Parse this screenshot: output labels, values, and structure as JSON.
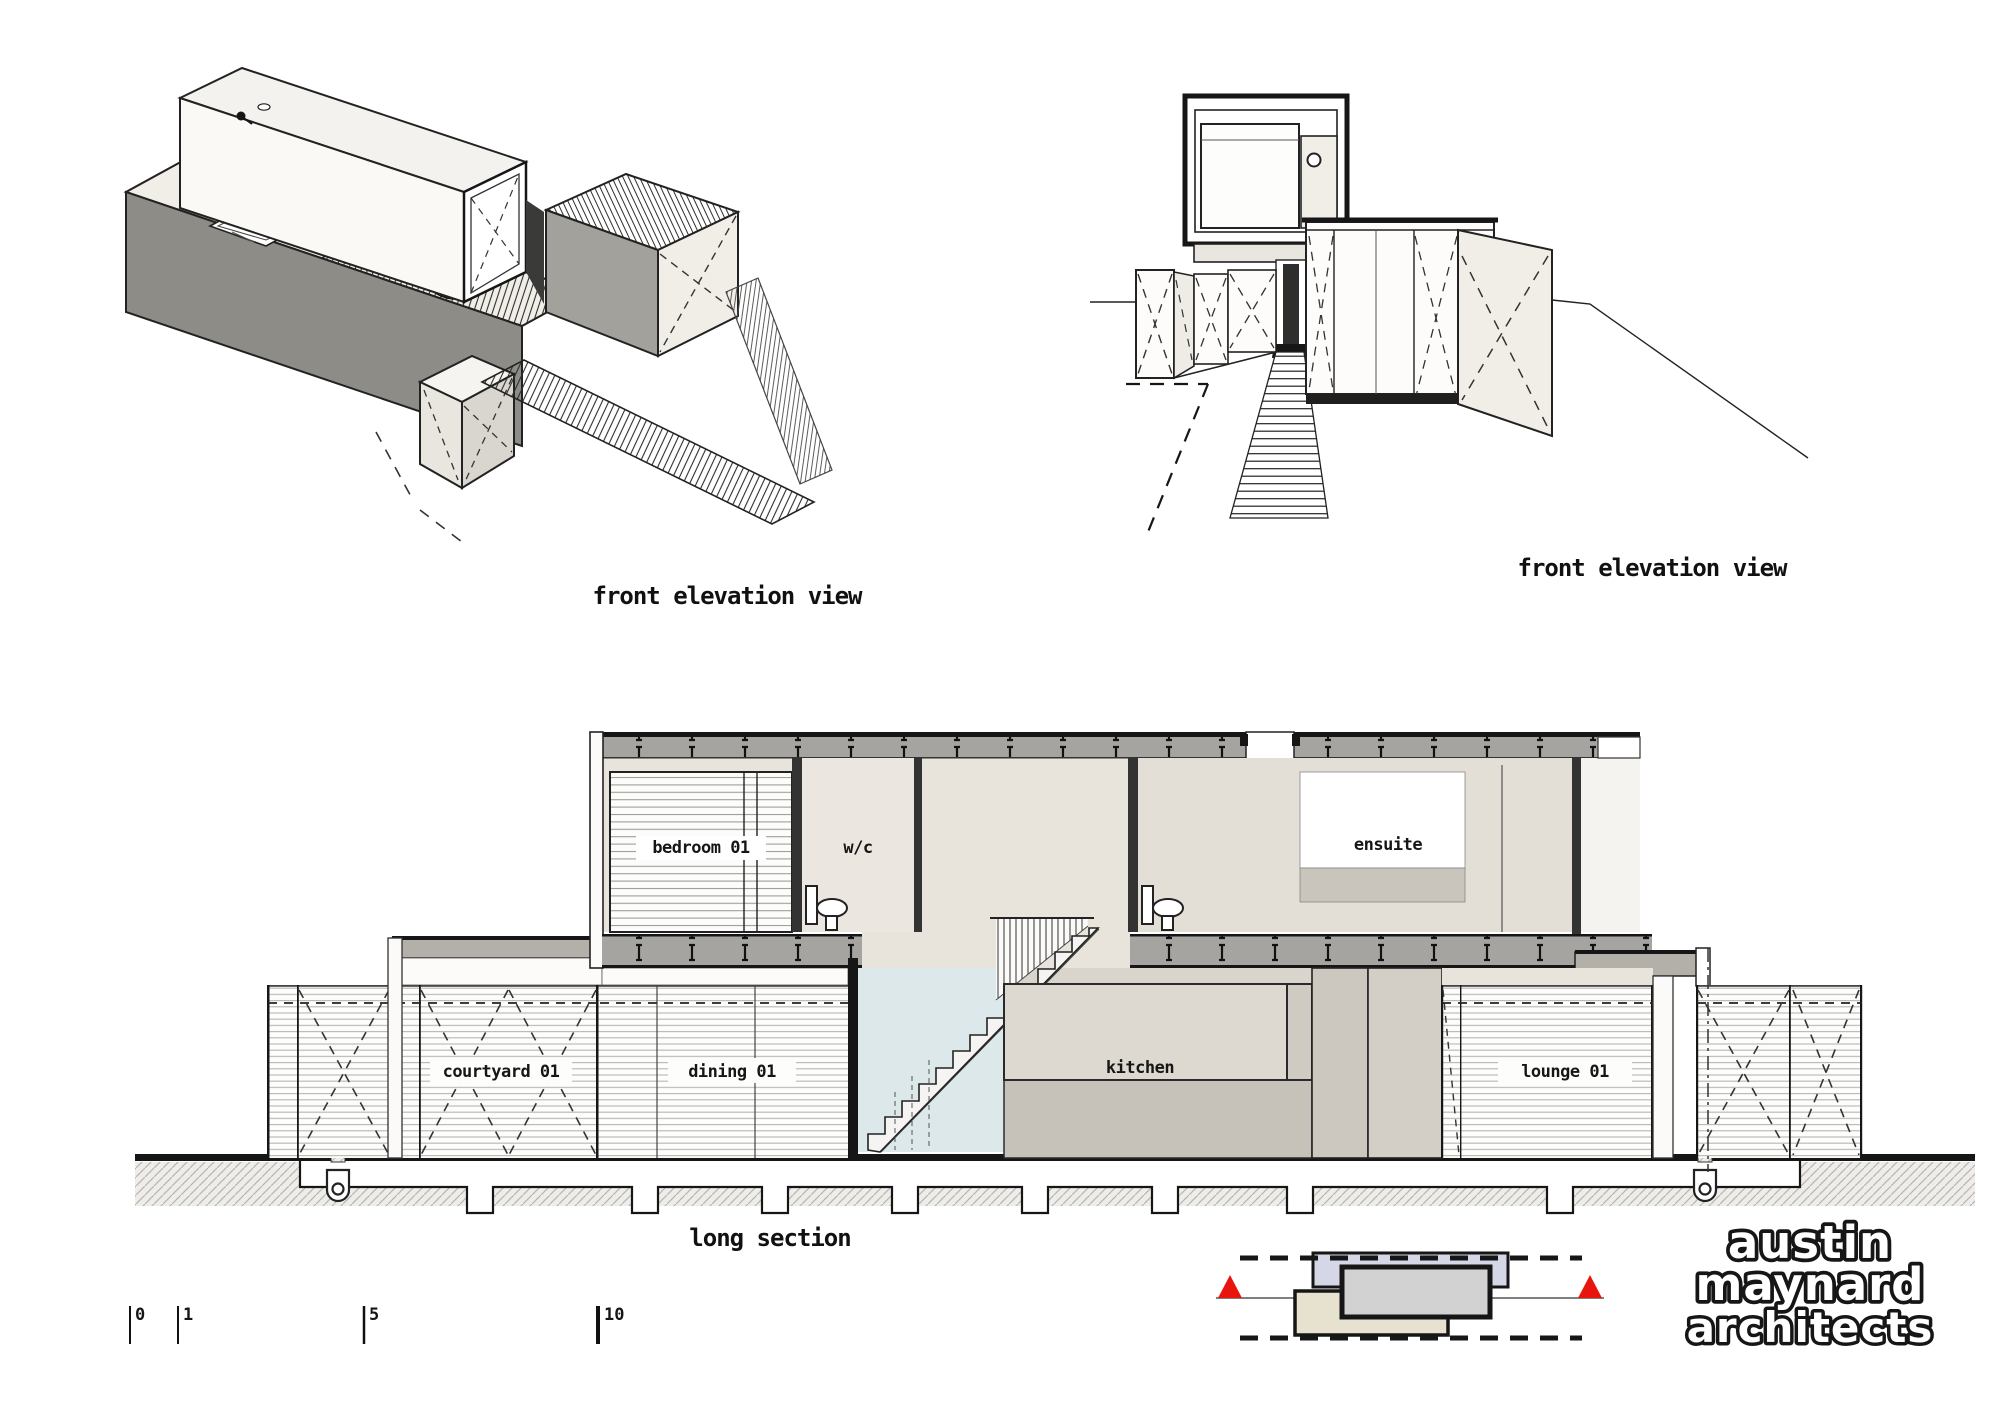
{
  "sheet": {
    "background": "#ffffff"
  },
  "views": {
    "axonometric": {
      "label": "front elevation view"
    },
    "perspective": {
      "label": "front elevation view"
    },
    "long_section": {
      "label": "long section",
      "rooms": {
        "bedroom": "bedroom 01",
        "wc": "w/c",
        "ensuite": "ensuite",
        "courtyard": "courtyard 01",
        "dining": "dining 01",
        "kitchen": "kitchen",
        "lounge": "lounge 01"
      }
    }
  },
  "scale_bar": {
    "tick_labels": [
      "0",
      "1",
      "5",
      "10"
    ]
  },
  "key_diagram": {
    "section_marker_color": "#e8150f",
    "upper_volume_fill": "#d5d7e7",
    "middle_volume_fill": "#d2d2d2",
    "lower_volume_fill": "#e7e2cf"
  },
  "logo": {
    "line1": "austin",
    "line2": "maynard",
    "line3": "architects"
  },
  "colors": {
    "pool": "#dce8ea",
    "roof_band": "#a6a4a1",
    "interior_beige": "#e8e3db",
    "ground_hatch_bg": "#efede9"
  }
}
